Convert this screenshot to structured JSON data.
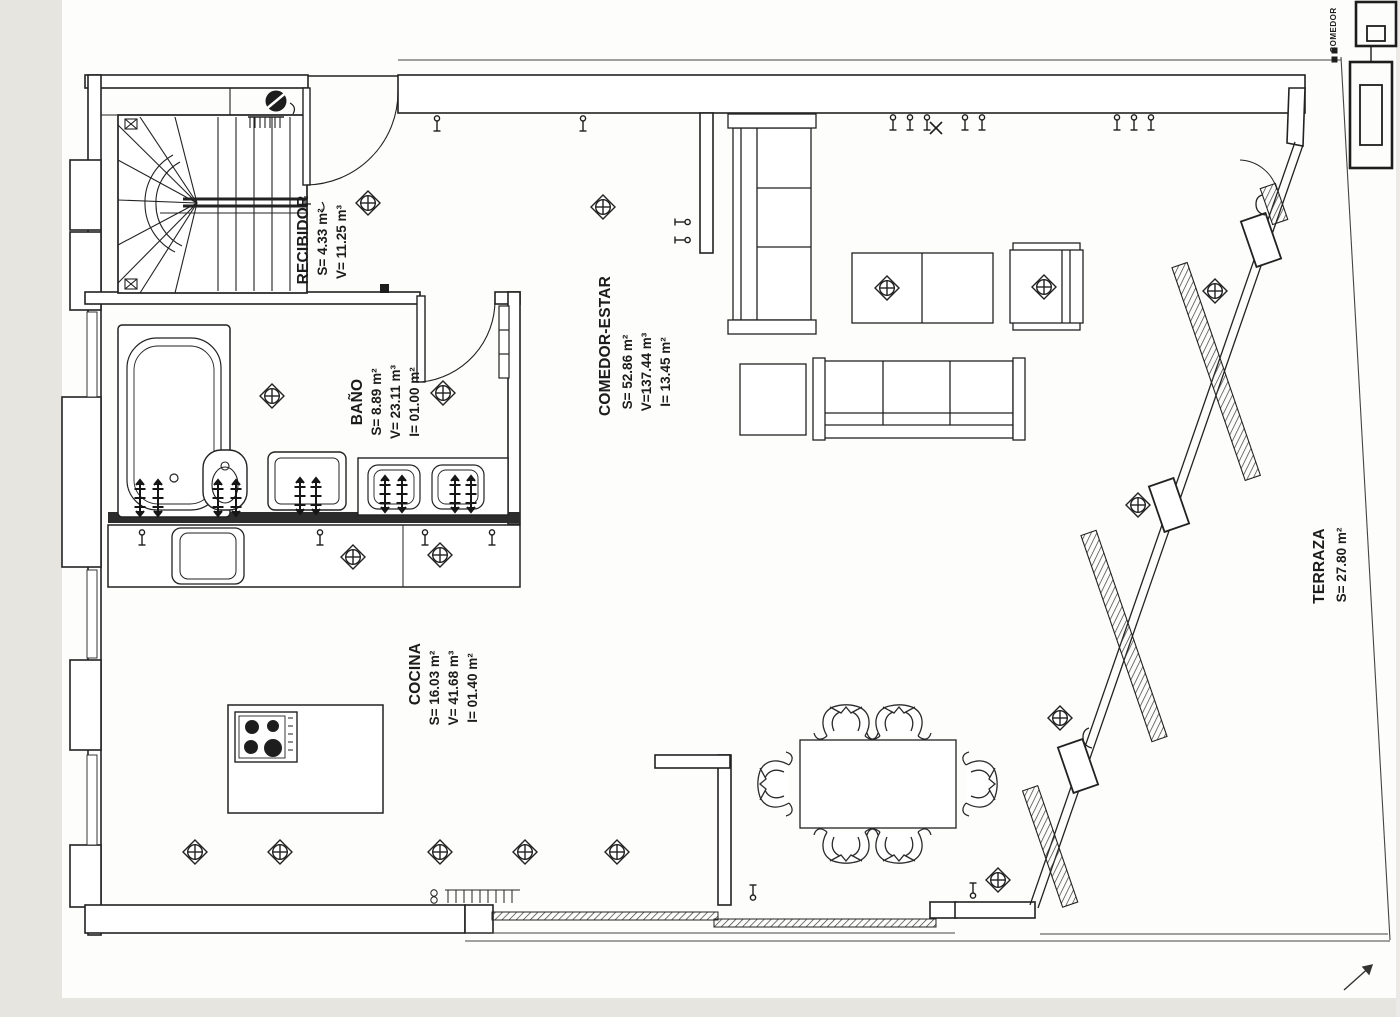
{
  "drawing_type": "architectural floor plan (scanned)",
  "rooms": {
    "recibidor": {
      "name": "RECIBIDOR",
      "s": "S= 4.33 m²",
      "v": "V= 11.25 m³"
    },
    "bano": {
      "name": "BAÑO",
      "s": "S= 8.89 m²",
      "v": "V= 23.11 m³",
      "i": "I= 01.00 m²"
    },
    "comedor_estar": {
      "name": "COMEDOR-ESTAR",
      "s": "S= 52.86 m²",
      "v": "V=137.44 m³",
      "i": "I= 13.45 m²"
    },
    "cocina": {
      "name": "COCINA",
      "s": "S= 16.03 m²",
      "v": "V= 41.68 m³",
      "i": "I= 01.40 m²"
    },
    "terraza": {
      "name": "TERRAZA",
      "s": "S= 27.80 m²"
    }
  },
  "title_block": {
    "corner_label": "COMEDOR"
  },
  "colors": {
    "ink": "#222222",
    "wet_wall": "#2c2c2c",
    "paper": "#ffffff",
    "scan_margin": "#e7e5e0"
  }
}
